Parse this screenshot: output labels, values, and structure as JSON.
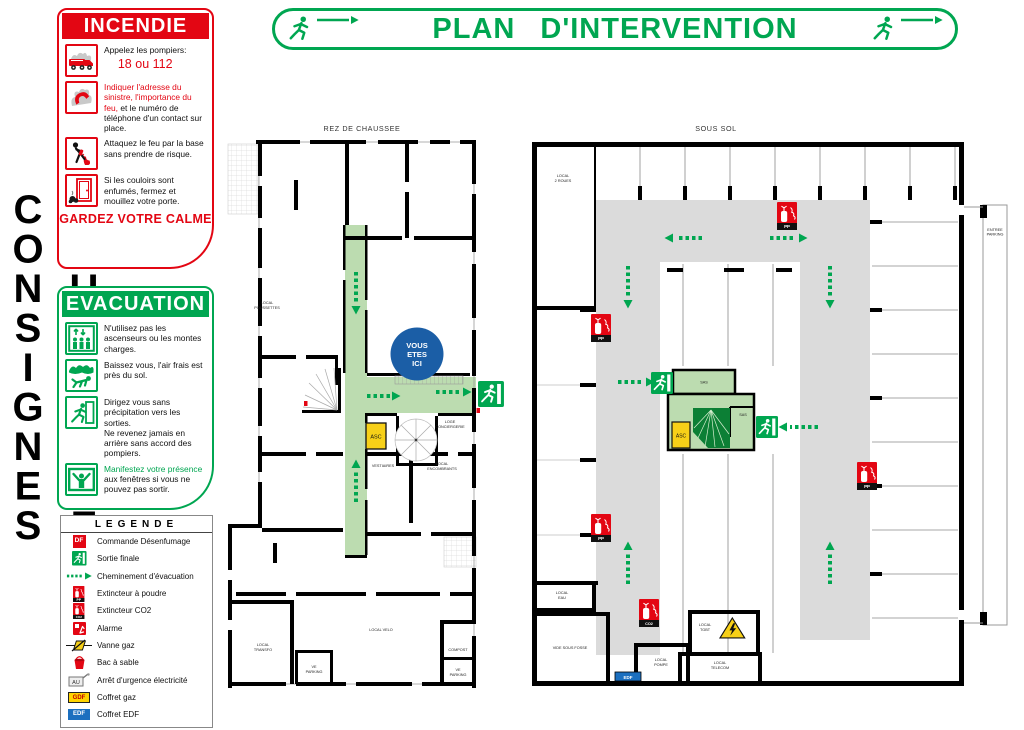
{
  "colors": {
    "red": "#E30613",
    "green": "#00A651",
    "pale_green": "#BCDCB0",
    "circulation_gray": "#DBDBDB",
    "stair_dark_green": "#0C7F35",
    "asc_yellow": "#F7D018",
    "here_blue": "#1B5EA6",
    "edf_blue": "#1B6FBF"
  },
  "vertical_title": "CONSIGNES D'URGENCE",
  "banner": {
    "title": "PLAN D'INTERVENTION"
  },
  "incendie": {
    "title": "INCENDIE",
    "item1_line1": "Appelez les pompiers:",
    "item1_line2": "18 ou 112",
    "item2_red": "Indiquer l'adresse du sinistre, l'importance du feu,",
    "item2_black": "et le numéro de téléphone d'un contact sur place.",
    "item3": "Attaquez le feu par la base sans prendre de risque.",
    "item4": "Si les couloirs sont enfumés, fermez et mouillez votre porte.",
    "footer": "GARDEZ VOTRE CALME"
  },
  "evacuation": {
    "title": "EVACUATION",
    "item1": "N'utilisez pas les ascenseurs ou les montes charges.",
    "item2": "Baissez vous, l'air frais est près du sol.",
    "item3a": "Dirigez vous sans précipitation vers les sorties.",
    "item3b": "Ne revenez jamais en arrière sans accord des pompiers.",
    "item4_green": "Manifestez votre présence",
    "item4_black": "aux fenêtres si vous ne pouvez pas sortir."
  },
  "legende": {
    "title": "LEGENDE",
    "badge_df": "DF",
    "badge_au": "AU",
    "badge_gdf": "GDF",
    "badge_edf": "EDF",
    "items": [
      "Commande Désenfumage",
      "Sortie finale",
      "Cheminement d'évacuation",
      "Extincteur à poudre",
      "Extincteur CO2",
      "Alarme",
      "Vanne gaz",
      "Bac à sable",
      "Arrêt d'urgence électricité",
      "Coffret gaz",
      "Coffret EDF"
    ]
  },
  "plans": {
    "rdc": {
      "title": "REZ DE CHAUSSEE",
      "you_are_here": [
        "VOUS",
        "ETES",
        "ICI"
      ],
      "asc": "ASC",
      "rooms": {
        "poussettes": [
          "LOCAL",
          "POUSSETTES"
        ],
        "loge": [
          "LOGE",
          "CONCIERGERIE"
        ],
        "vestiaires": [
          "VESTIAIRES"
        ],
        "encombrants": [
          "LOCAL",
          "ENCOMBRANTS"
        ],
        "velo": [
          "LOCAL VELO"
        ],
        "transfo": [
          "LOCAL",
          "TRANSFO"
        ],
        "ve1": [
          "VE",
          "PARKING"
        ],
        "compost": [
          "COMPOST"
        ],
        "ve2": [
          "VE",
          "PARKING"
        ]
      }
    },
    "soussol": {
      "title": "SOUS SOL",
      "asc": "ASC",
      "ext_pp": "PP",
      "ext_co2": "CO2",
      "edf": "EDF",
      "rooms": {
        "deuxroues": [
          "LOCAL",
          "2 ROUES"
        ],
        "sas1": [
          "SAS"
        ],
        "sas2": [
          "SAS"
        ],
        "eau": [
          "LOCAL",
          "EAU"
        ],
        "fosse": [
          "VIDE SOUS FOSSE"
        ],
        "pompe": [
          "LOCAL",
          "POMPE"
        ],
        "tgbt": [
          "LOCAL",
          "TGBT"
        ],
        "telecom": [
          "LOCAL",
          "TELECOM"
        ],
        "ramp": [
          "ENTREE",
          "PARKING"
        ]
      }
    }
  }
}
